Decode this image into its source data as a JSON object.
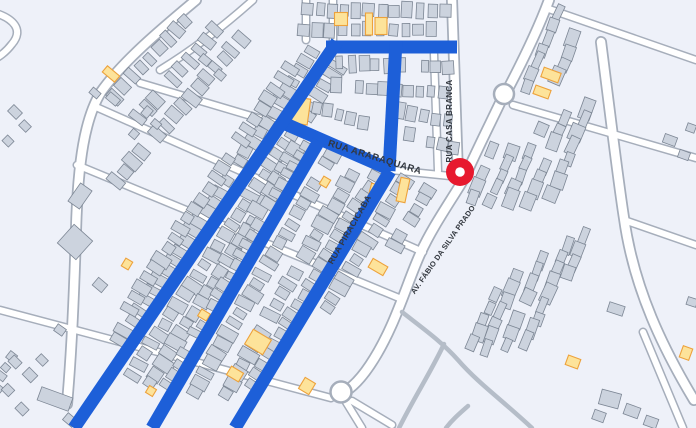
{
  "map": {
    "colors": {
      "background": "#eef1f9",
      "building_fill": "#ccd3de",
      "building_stroke": "#7c8694",
      "yellow_fill": "#fde39a",
      "yellow_stroke": "#eda23c",
      "road_fill": "#ffffff",
      "road_casing": "#a6aebb",
      "route_blue": "#1d5fd8",
      "path_gray": "#b5bdc8",
      "label_color": "#33383f",
      "marker_red": "#e7192e"
    },
    "marker": {
      "x": 460,
      "y": 172,
      "outer_r": 14,
      "inner_r": 4.8
    },
    "labels": [
      {
        "text": "RUA ARARAQUARA",
        "x": 374,
        "y": 160,
        "rot": 17,
        "size": 9.5,
        "weight": 700,
        "ls": 0.4
      },
      {
        "text": "RUA CASA BRANCA",
        "x": 452,
        "y": 121,
        "rot": -90,
        "size": 8,
        "weight": 700,
        "ls": 0.3
      },
      {
        "text": "RUA PIRACICABA",
        "x": 352,
        "y": 231,
        "rot": -60,
        "size": 8.5,
        "weight": 700,
        "ls": 0.3
      },
      {
        "text": "AV. FÁBIO DA SILVA PRADO",
        "x": 445,
        "y": 251,
        "rot": -55,
        "size": 7.5,
        "weight": 700,
        "ls": 0.2
      }
    ],
    "blue_routes": [
      {
        "name": "route-top-horizontal",
        "d": "M326,47 L457,47"
      },
      {
        "name": "route-top-vertical",
        "d": "M396,41 L389,171"
      },
      {
        "name": "route-rua-araraquara",
        "d": "M281,122 L391,170"
      },
      {
        "name": "route-diagonal-1",
        "d": "M337,42 L74,428"
      },
      {
        "name": "route-diagonal-2",
        "d": "M319,141 L152,428"
      },
      {
        "name": "route-rua-piracicaba",
        "d": "M390,171 L235,428"
      }
    ],
    "roads_major": [
      "M196,0 C160,30 122,62 101,92 C85,118 78,160 76,230 C74,300 71,360 67,404",
      "M462,182 C448,205 432,228 421,252 C407,282 395,328 370,365 C360,380 352,387 346,391",
      "M452,0 L458,177",
      "M549,0 C538,30 521,64 508,89",
      "M500,103 C488,128 474,156 464,179",
      "M601,42 C611,120 618,180 624,218 C634,290 664,350 694,400"
    ],
    "roads_minor": [
      "M253,0 C225,25 196,48 160,70",
      "M140,83 L285,126",
      "M391,170 L450,176",
      "M96,107 L423,252",
      "M77,165 L399,298",
      "M0,310 L331,398",
      "M352,401 L392,425",
      "M346,402 L362,428",
      "M333,0 L333,44",
      "M306,0 L306,40",
      "M434,54 L438,171",
      "M546,8 L696,60",
      "M513,105 L696,158",
      "M624,220 L696,245",
      "M643,332 L683,428",
      "M-8,12 C14,18 24,30 12,44 C6,52 -2,58 -8,60"
    ],
    "gray_paths": [
      "M402,312 C425,330 442,342 458,360 C478,383 502,400 532,428",
      "M444,344 C432,370 415,396 399,428",
      "M468,406 C459,414 452,420 446,428"
    ],
    "roundabouts": [
      {
        "x": 504,
        "y": 94,
        "r": 10
      },
      {
        "x": 341,
        "y": 392,
        "r": 10.5
      }
    ],
    "building_strips": [
      [
        313,
        52,
        124,
        30,
        12,
        15,
        9,
        31
      ],
      [
        296,
        60,
        124,
        26,
        12,
        14,
        9,
        32
      ],
      [
        339,
        66,
        124,
        32,
        12,
        15,
        9,
        31
      ],
      [
        296,
        150,
        122,
        24,
        12,
        15,
        10,
        31
      ],
      [
        306,
        146,
        120,
        25,
        11.5,
        15,
        9,
        30
      ],
      [
        332,
        154,
        120,
        25,
        11.5,
        15,
        9,
        30
      ],
      [
        352,
        175,
        120,
        23,
        11.5,
        15,
        10,
        30
      ],
      [
        376,
        178,
        121,
        22,
        11.5,
        15,
        9,
        31
      ],
      [
        404,
        180,
        121,
        14,
        11.5,
        15,
        9,
        31
      ],
      [
        428,
        190,
        121,
        8,
        11,
        14,
        9,
        31
      ],
      [
        215,
        30,
        131,
        10,
        13,
        14,
        9,
        41
      ],
      [
        240,
        40,
        131,
        16,
        12.5,
        14,
        9,
        41
      ],
      [
        185,
        20,
        133,
        9,
        13,
        13,
        9,
        43
      ],
      [
        307,
        10,
        0,
        12,
        12.5,
        9,
        14,
        3
      ],
      [
        305,
        30,
        0,
        12,
        12.5,
        9,
        13,
        2
      ],
      [
        340,
        63,
        2,
        10,
        12,
        9,
        14,
        0
      ],
      [
        336,
        86,
        4,
        10,
        12,
        9,
        13,
        5
      ],
      [
        305,
        104,
        18,
        6,
        12,
        9,
        13,
        10
      ],
      [
        400,
        110,
        14,
        5,
        12,
        9,
        13,
        8
      ],
      [
        408,
        135,
        16,
        5,
        12,
        9,
        13,
        10
      ],
      [
        558,
        14,
        113,
        7,
        13,
        10,
        16,
        22
      ],
      [
        578,
        28,
        113,
        5,
        13,
        10,
        15,
        22
      ],
      [
        492,
        150,
        113,
        5,
        13,
        10,
        15,
        22
      ],
      [
        516,
        140,
        113,
        6,
        13,
        10,
        16,
        22
      ],
      [
        540,
        128,
        113,
        7,
        13,
        10,
        16,
        22
      ],
      [
        564,
        118,
        113,
        8,
        13,
        10,
        16,
        22
      ],
      [
        588,
        110,
        113,
        8,
        13,
        11,
        17,
        22
      ],
      [
        568,
        246,
        113,
        9,
        13,
        10,
        16,
        22
      ],
      [
        542,
        260,
        113,
        8,
        13,
        10,
        16,
        22
      ],
      [
        516,
        276,
        113,
        7,
        13,
        10,
        16,
        22
      ],
      [
        494,
        296,
        113,
        5,
        13,
        10,
        15,
        22
      ],
      [
        584,
        238,
        113,
        4,
        13,
        10,
        15,
        22
      ],
      [
        12,
        358,
        118,
        5,
        11,
        10,
        8,
        40
      ]
    ],
    "building_scatter": [
      [
        95,
        93,
        10,
        7,
        40
      ],
      [
        113,
        99,
        13,
        8,
        40
      ],
      [
        147,
        112,
        8,
        10,
        40
      ],
      [
        156,
        124,
        9,
        7,
        40
      ],
      [
        134,
        134,
        8,
        8,
        40
      ],
      [
        80,
        196,
        14,
        22,
        35
      ],
      [
        75,
        242,
        25,
        25,
        42
      ],
      [
        100,
        285,
        12,
        10,
        40
      ],
      [
        60,
        330,
        10,
        8,
        35
      ],
      [
        15,
        112,
        12,
        9,
        45
      ],
      [
        25,
        126,
        10,
        8,
        45
      ],
      [
        8,
        141,
        9,
        8,
        45
      ],
      [
        55,
        399,
        33,
        14,
        20
      ],
      [
        30,
        375,
        12,
        10,
        45
      ],
      [
        15,
        362,
        11,
        9,
        45
      ],
      [
        42,
        360,
        10,
        8,
        45
      ],
      [
        8,
        390,
        10,
        9,
        45
      ],
      [
        22,
        409,
        11,
        9,
        45
      ],
      [
        70,
        420,
        12,
        9,
        40
      ],
      [
        670,
        140,
        13,
        9,
        20
      ],
      [
        684,
        155,
        11,
        8,
        20
      ],
      [
        691,
        128,
        9,
        8,
        20
      ],
      [
        616,
        309,
        16,
        10,
        18
      ],
      [
        692,
        302,
        10,
        8,
        18
      ],
      [
        610,
        399,
        20,
        15,
        15
      ],
      [
        632,
        411,
        15,
        11,
        20
      ],
      [
        651,
        422,
        13,
        10,
        20
      ],
      [
        599,
        416,
        12,
        10,
        20
      ],
      [
        205,
        60,
        11,
        8,
        40
      ],
      [
        220,
        75,
        10,
        8,
        40
      ]
    ],
    "yellow_buildings": [
      [
        341,
        19,
        13,
        13,
        0
      ],
      [
        369,
        24,
        7,
        22,
        0
      ],
      [
        381,
        26,
        12,
        17,
        0
      ],
      [
        301,
        111,
        16,
        26,
        8
      ],
      [
        325,
        182,
        8,
        9,
        31
      ],
      [
        374,
        192,
        9,
        16,
        14
      ],
      [
        403,
        190,
        9,
        24,
        12
      ],
      [
        378,
        267,
        17,
        10,
        30
      ],
      [
        111,
        74,
        16,
        8,
        40
      ],
      [
        258,
        342,
        21,
        17,
        31
      ],
      [
        204,
        315,
        10,
        8,
        31
      ],
      [
        235,
        374,
        14,
        10,
        31
      ],
      [
        151,
        391,
        8,
        8,
        31
      ],
      [
        307,
        386,
        12,
        13,
        31
      ],
      [
        127,
        264,
        8,
        9,
        31
      ],
      [
        551,
        75,
        18,
        10,
        20
      ],
      [
        542,
        92,
        16,
        9,
        20
      ],
      [
        573,
        362,
        13,
        10,
        20
      ],
      [
        686,
        353,
        10,
        12,
        20
      ]
    ]
  }
}
